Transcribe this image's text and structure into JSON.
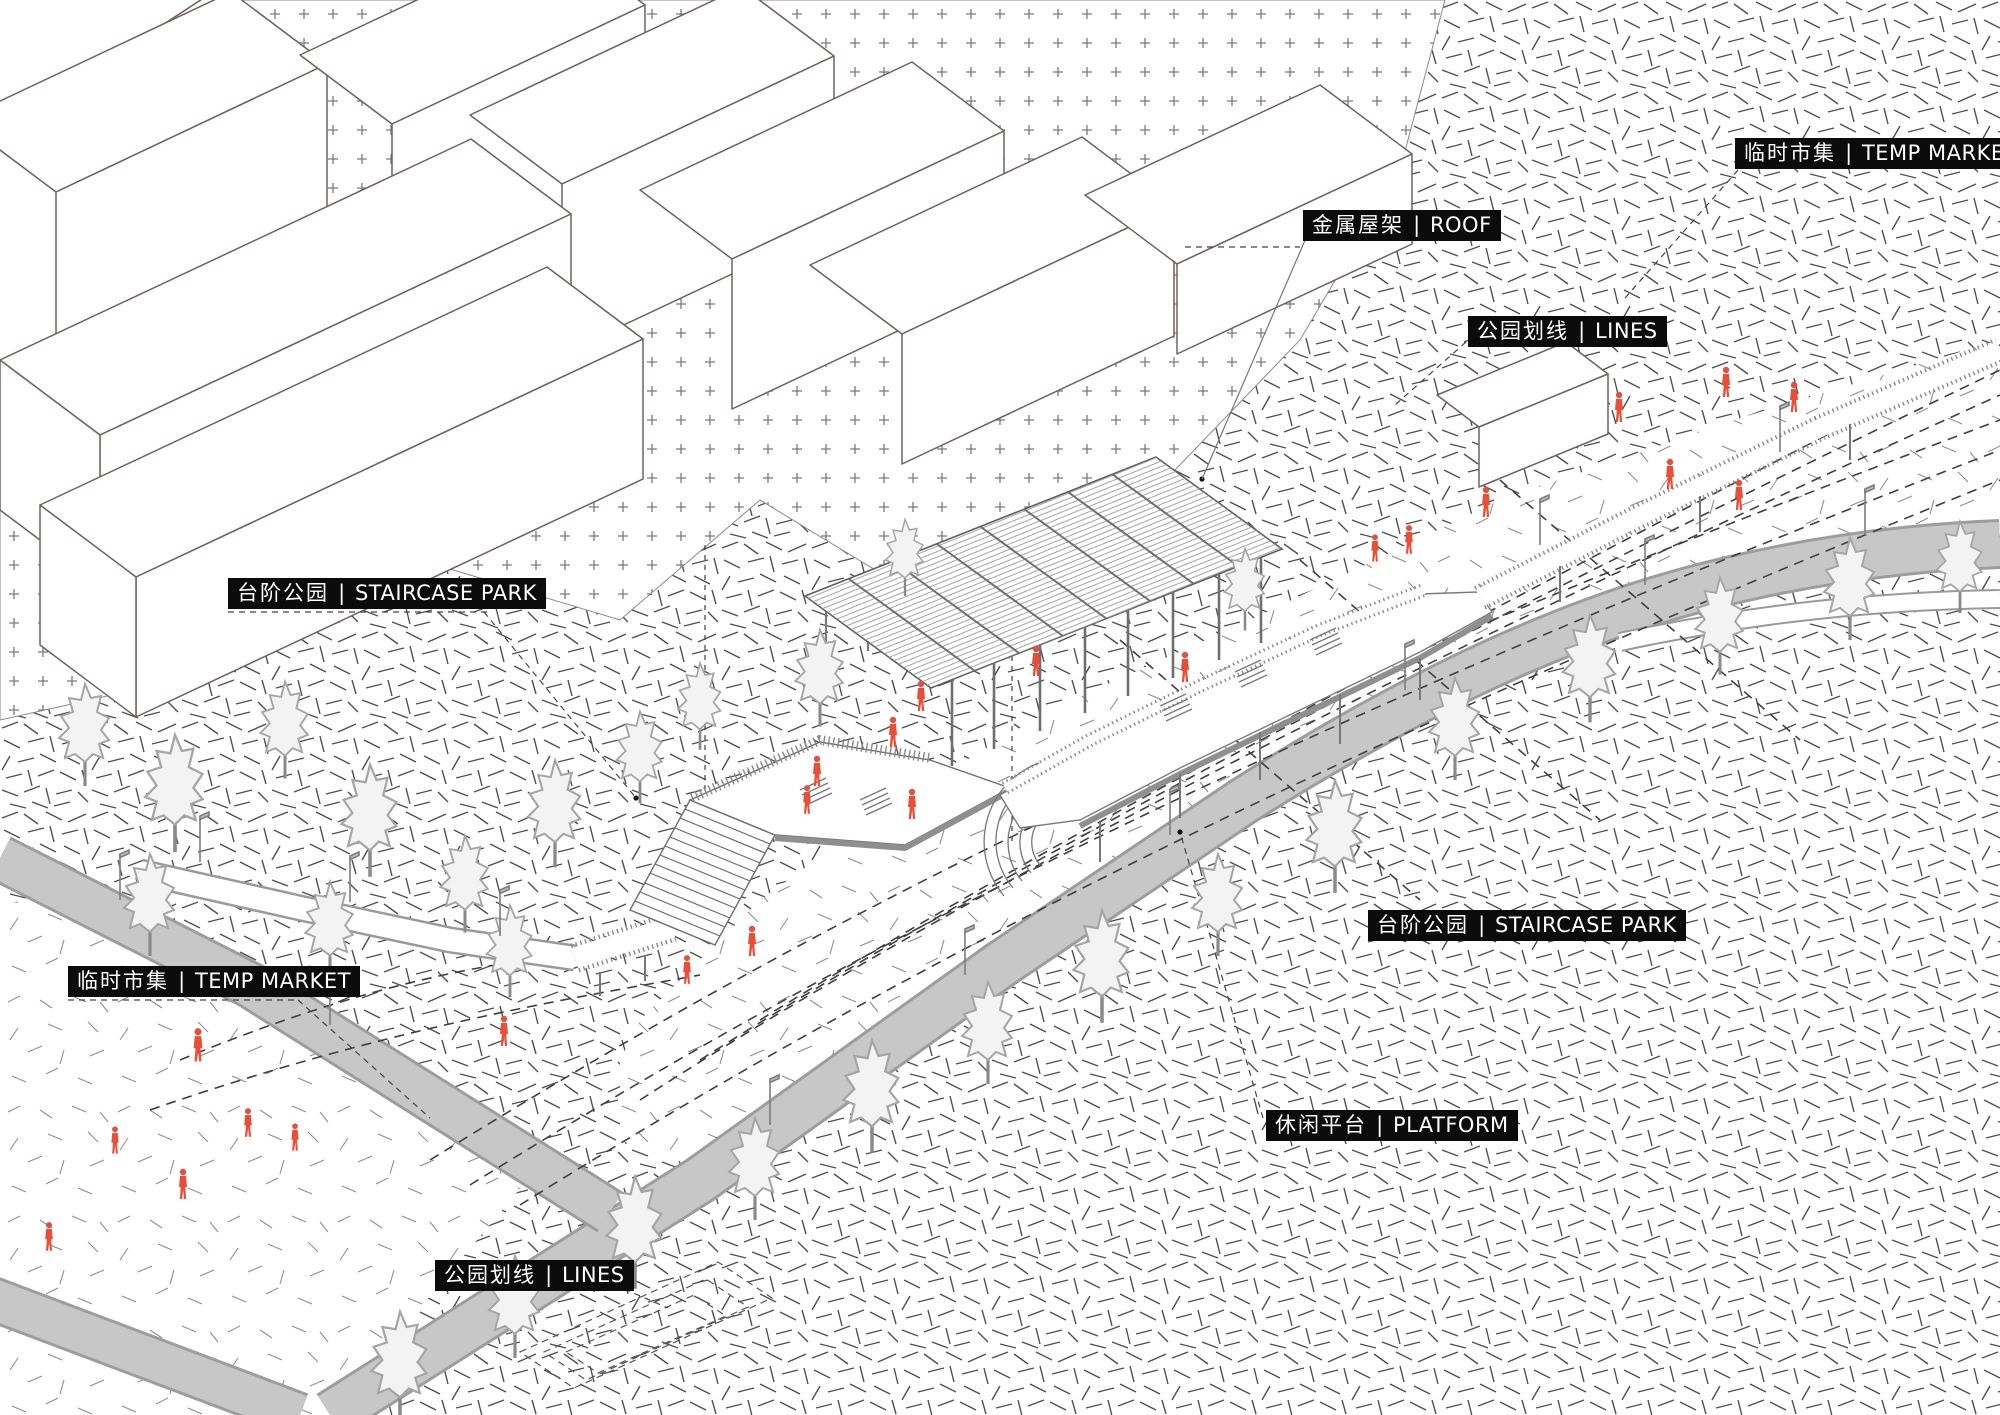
{
  "figure": {
    "type": "axonometric-site-diagram",
    "subject": "staircase park with temp market, canopy roof, platform and park lines"
  },
  "separator": " | ",
  "annotations": [
    {
      "id": "temp-market-ne",
      "zh": "临时市集",
      "en": "TEMP MARKET"
    },
    {
      "id": "roof",
      "zh": "金属屋架",
      "en": "ROOF"
    },
    {
      "id": "lines-e",
      "zh": "公园划线",
      "en": "LINES"
    },
    {
      "id": "staircase-park-w",
      "zh": "台阶公园",
      "en": "STAIRCASE PARK"
    },
    {
      "id": "staircase-park-e",
      "zh": "台阶公园",
      "en": "STAIRCASE PARK"
    },
    {
      "id": "temp-market-w",
      "zh": "临时市集",
      "en": "TEMP MARKET"
    },
    {
      "id": "platform",
      "zh": "休闲平台",
      "en": "PLATFORM"
    },
    {
      "id": "lines-s",
      "zh": "公园划线",
      "en": "LINES"
    }
  ],
  "colors": {
    "accent_red": "#e84f38",
    "road_gray": "#c7c7c7",
    "ink": "#5f5855",
    "label_bg": "#0b0b0b",
    "label_text": "#ffffff"
  }
}
